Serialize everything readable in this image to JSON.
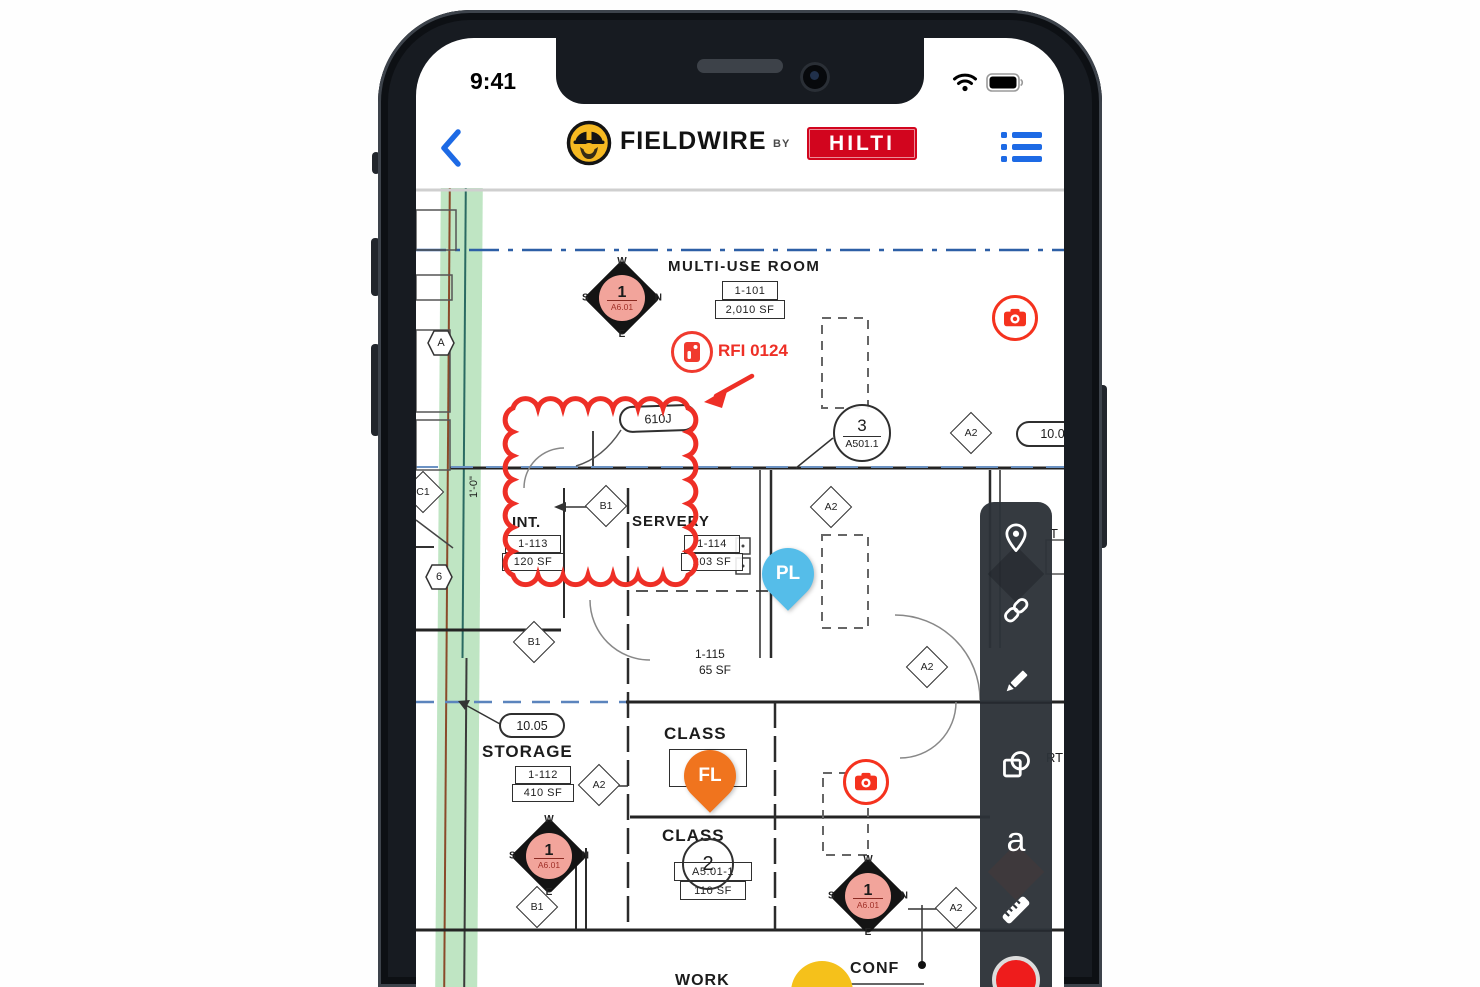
{
  "status_bar": {
    "time": "9:41"
  },
  "header": {
    "app_name": "FIELDWIRE",
    "by_label": "BY",
    "brand": "HILTI"
  },
  "colors": {
    "annotation_red": "#ee2f26",
    "hilti_red": "#d2051e",
    "logo_yellow": "#f6b921",
    "action_blue": "#1d6ae5",
    "pin_blue": "#55bde9",
    "pin_orange": "#f0741e",
    "keynote_fill": "#f2a49b",
    "stripe_green": "#bfe5c3",
    "record_red": "#ee1c1c"
  },
  "plan": {
    "rooms": {
      "multi_use": {
        "name": "MULTI-USE ROOM",
        "number": "1-101",
        "area": "2,010 SF"
      },
      "int_room": {
        "name": "INT.",
        "number": "1-113",
        "area": "120 SF"
      },
      "servery": {
        "name": "SERVERY",
        "number": "1-114",
        "area": "203 SF"
      },
      "room_1115": {
        "number": "1-115",
        "area": "65 SF"
      },
      "storage": {
        "name": "STORAGE",
        "number": "1-112",
        "area": "410 SF"
      },
      "class_1": {
        "name": "CLASS",
        "number": "1-110"
      },
      "class_2": {
        "name": "CLASS",
        "number": "2",
        "sheet": "A5.01-1",
        "area": "110 SF"
      },
      "conf": {
        "name": "CONF"
      },
      "work": {
        "name": "WORK"
      }
    },
    "tags": {
      "a2": "A2",
      "b1": "B1",
      "c1": "C1",
      "hex_a": "A",
      "hex_6": "6",
      "grid_bubble": "10.05",
      "grid_bubble_right": "10.05",
      "door_tag": "610J",
      "dim": "1'-0\""
    },
    "keynote": {
      "number": "1",
      "sheet": "A6.01",
      "w": "W",
      "n": "N",
      "s": "S",
      "e": "E"
    },
    "callout": {
      "number": "3",
      "sheet": "A501.1"
    },
    "fragments": {
      "t": "T",
      "rt": "RT"
    },
    "annotations": {
      "rfi_label": "RFI 0124"
    },
    "pins": {
      "pl": "PL",
      "fl": "FL"
    }
  },
  "toolbar": {
    "text_tool_glyph": "a"
  }
}
